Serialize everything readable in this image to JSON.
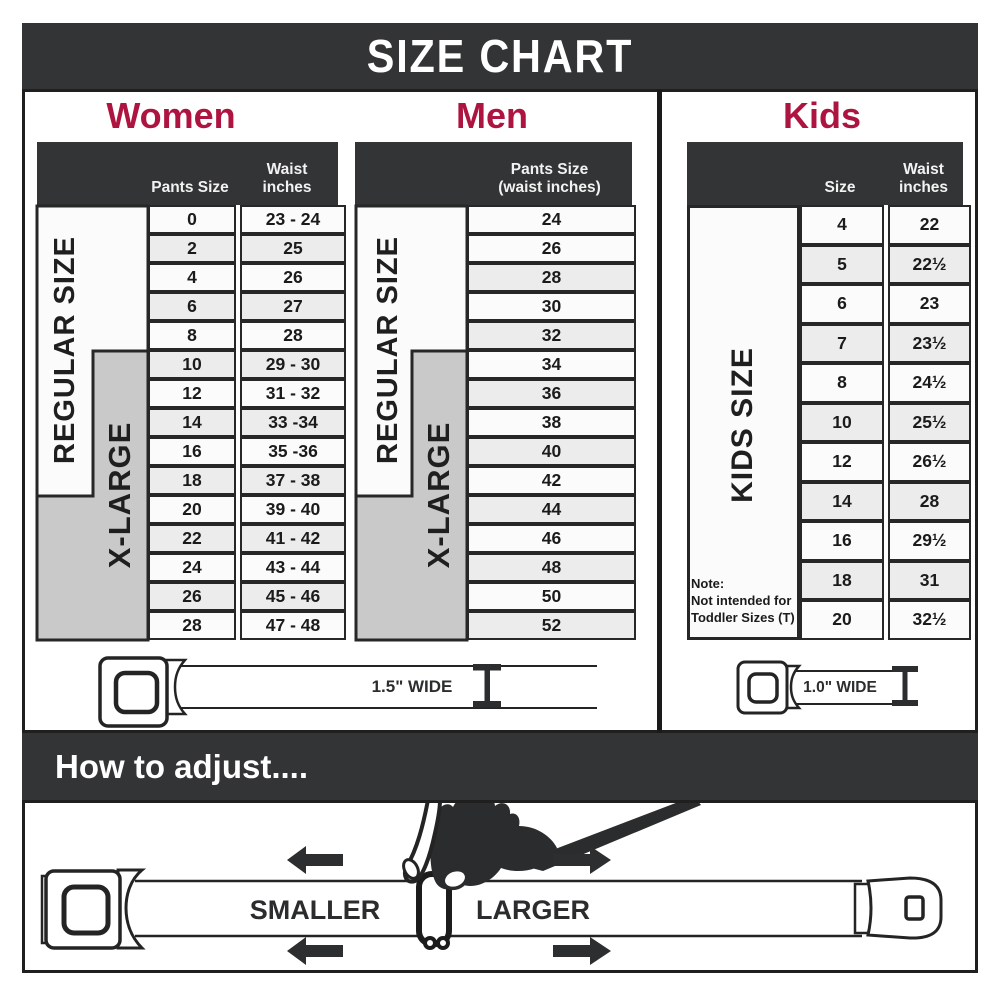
{
  "title": "SIZE CHART",
  "colors": {
    "header_bar": "#323435",
    "accent_red": "#ae1440",
    "row_light": "#fbfbfb",
    "row_shaded": "#ececec",
    "xlarge_gray": "#c9c9c9",
    "line_black": "#272727"
  },
  "sections": {
    "women": {
      "heading": "Women",
      "size_header": "Pants Size",
      "waist_header_line1": "Waist",
      "waist_header_line2": "inches",
      "regular_label": "REGULAR SIZE",
      "xlarge_label": "X-LARGE",
      "rows": [
        {
          "size": "0",
          "waist": "23 - 24"
        },
        {
          "size": "2",
          "waist": "25"
        },
        {
          "size": "4",
          "waist": "26"
        },
        {
          "size": "6",
          "waist": "27"
        },
        {
          "size": "8",
          "waist": "28"
        },
        {
          "size": "10",
          "waist": "29 - 30"
        },
        {
          "size": "12",
          "waist": "31 - 32"
        },
        {
          "size": "14",
          "waist": "33 -34"
        },
        {
          "size": "16",
          "waist": "35 -36"
        },
        {
          "size": "18",
          "waist": "37 - 38"
        },
        {
          "size": "20",
          "waist": "39 - 40"
        },
        {
          "size": "22",
          "waist": "41 - 42"
        },
        {
          "size": "24",
          "waist": "43 - 44"
        },
        {
          "size": "26",
          "waist": "45 - 46"
        },
        {
          "size": "28",
          "waist": "47 - 48"
        }
      ],
      "shaded_rows": [
        1,
        3,
        5,
        7,
        9,
        11,
        13
      ]
    },
    "men": {
      "heading": "Men",
      "header_line1": "Pants Size",
      "header_line2": "(waist inches)",
      "regular_label": "REGULAR SIZE",
      "xlarge_label": "X-LARGE",
      "rows": [
        "24",
        "26",
        "28",
        "30",
        "32",
        "34",
        "36",
        "38",
        "40",
        "42",
        "44",
        "46",
        "48",
        "50",
        "52"
      ],
      "shaded_rows": [
        2,
        4,
        6,
        8,
        10,
        12,
        14
      ]
    },
    "kids": {
      "heading": "Kids",
      "size_header": "Size",
      "waist_header_line1": "Waist",
      "waist_header_line2": "inches",
      "side_label": "KIDS SIZE",
      "note_lines": [
        "Note:",
        "Not intended for",
        "Toddler Sizes (T)"
      ],
      "rows": [
        {
          "size": "4",
          "waist": "22"
        },
        {
          "size": "5",
          "waist": "22½"
        },
        {
          "size": "6",
          "waist": "23"
        },
        {
          "size": "7",
          "waist": "23½"
        },
        {
          "size": "8",
          "waist": "24½"
        },
        {
          "size": "10",
          "waist": "25½"
        },
        {
          "size": "12",
          "waist": "26½"
        },
        {
          "size": "14",
          "waist": "28"
        },
        {
          "size": "16",
          "waist": "29½"
        },
        {
          "size": "18",
          "waist": "31"
        },
        {
          "size": "20",
          "waist": "32½"
        }
      ],
      "shaded_rows": [
        1,
        3,
        5,
        7,
        9
      ]
    }
  },
  "belts": {
    "adult_width_label": "1.5\" WIDE",
    "kids_width_label": "1.0\" WIDE"
  },
  "adjust": {
    "heading": "How to adjust....",
    "smaller_label": "SMALLER",
    "larger_label": "LARGER"
  }
}
